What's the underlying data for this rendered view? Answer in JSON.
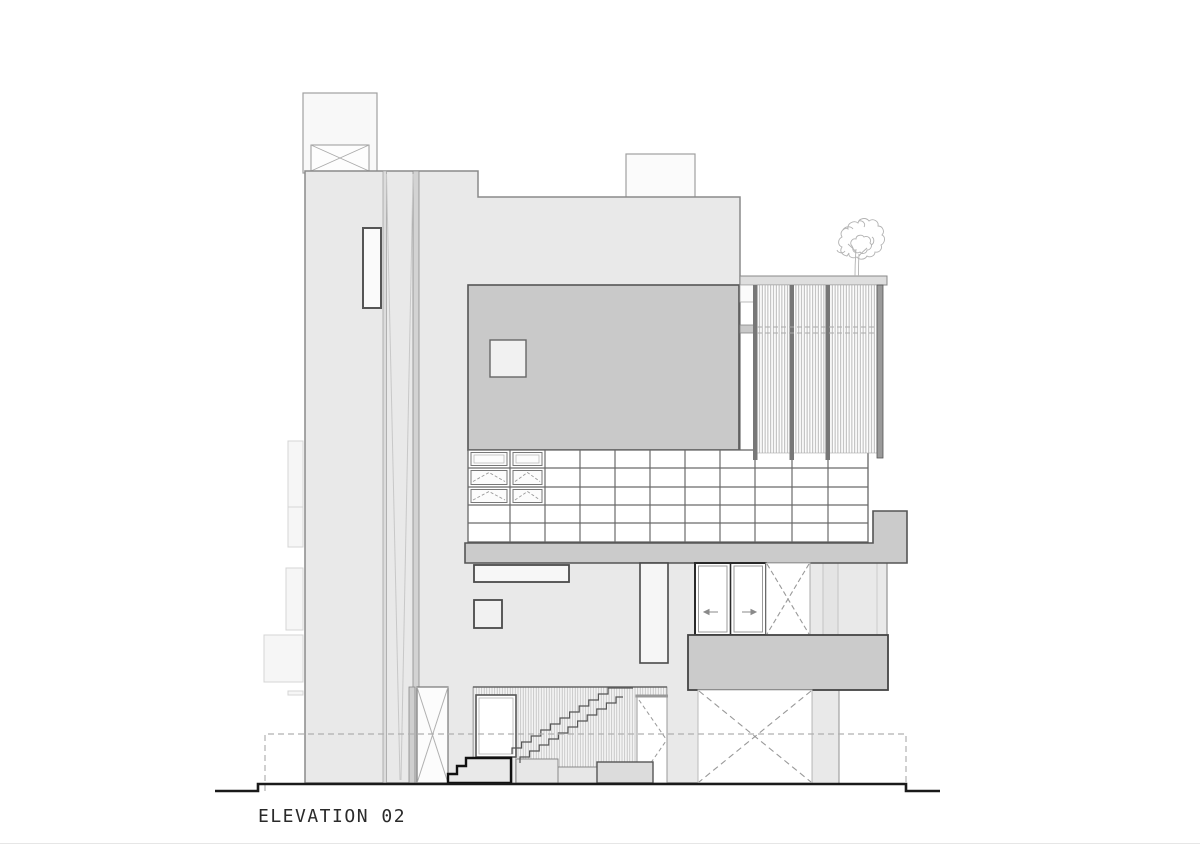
{
  "sheet": {
    "title": "ELEVATION 02"
  },
  "palette": {
    "background": "#ffffff",
    "wall_fill": "#e9e9e9",
    "dark_panel_fill": "#c9c9c9",
    "slab_fill": "#cbcbcb",
    "light_panel_fill": "#f7f7f7",
    "outline": "#8a8a8a",
    "heavy_line": "#1a1a1a",
    "dashed_line": "#b0b0b0",
    "hatch_line": "#b8b8b8"
  }
}
